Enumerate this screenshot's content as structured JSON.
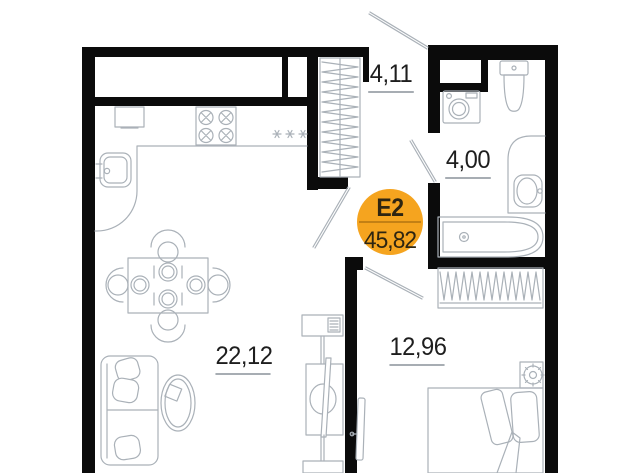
{
  "plan": {
    "badge": {
      "unit_code": "Е2",
      "total_area": "45,82"
    },
    "rooms": [
      {
        "id": "hallway",
        "area": "4,11"
      },
      {
        "id": "bathroom",
        "area": "4,00"
      },
      {
        "id": "living-kitchen",
        "area": "22,12"
      },
      {
        "id": "bedroom",
        "area": "12,96"
      }
    ],
    "colors": {
      "wall": "#0b0b0b",
      "line": "#aab1b8",
      "label": "#1e1e1e",
      "underline": "#a7adb3",
      "badge": "#F5A41F",
      "badge_text": "#2e2511"
    }
  }
}
